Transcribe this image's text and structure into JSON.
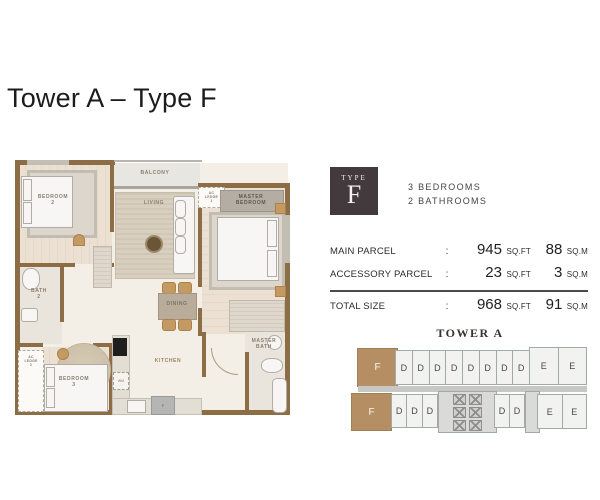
{
  "page": {
    "title": "Tower A – Type F"
  },
  "badge": {
    "type_label": "TYPE",
    "letter": "F"
  },
  "specs": {
    "bedrooms": "3 BEDROOMS",
    "bathrooms": "2 BATHROOMS"
  },
  "size_table": {
    "colon": ":",
    "rows": [
      {
        "label": "MAIN PARCEL",
        "sqft": "945",
        "sqft_unit": "SQ.FT",
        "sqm": "88",
        "sqm_unit": "SQ.M"
      },
      {
        "label": "ACCESSORY PARCEL",
        "sqft": "23",
        "sqft_unit": "SQ.FT",
        "sqm": "3",
        "sqm_unit": "SQ.M"
      },
      {
        "label": "TOTAL SIZE",
        "sqft": "968",
        "sqft_unit": "SQ.FT",
        "sqm": "91",
        "sqm_unit": "SQ.M"
      }
    ]
  },
  "tower": {
    "title": "TOWER A",
    "top_row": [
      "F",
      "D",
      "D",
      "D",
      "D",
      "D",
      "D",
      "D",
      "D",
      "E",
      "E"
    ],
    "bottom_f": "F",
    "bottom_left": [
      "D",
      "D",
      "D"
    ],
    "bottom_mid": [
      "D",
      "D"
    ],
    "bottom_right": [
      "E",
      "E"
    ]
  },
  "floorplan": {
    "labels": {
      "balcony": "BALCONY",
      "living": "LIVING",
      "dining": "DINING",
      "kitchen": "KITCHEN",
      "bedroom2": "BEDROOM\n2",
      "bath2": "BATH\n2",
      "bedroom3": "BEDROOM\n3",
      "master_bedroom": "MASTER\nBEDROOM",
      "master_bath": "MASTER\nBATH",
      "ac_ledge1": "AC\nLEDGE\n1",
      "ac_ledge2": "AC\nLEDGE\n2",
      "wm": "WM",
      "fridge": "F"
    }
  },
  "colors": {
    "wall_brown": "#8d6d46",
    "unit_f_tan": "#b68e63",
    "badge_bg": "#423a3c",
    "cell_bg": "#f2f2f0",
    "core_gray": "#dadad8",
    "floor_cream": "#f3eee6"
  }
}
